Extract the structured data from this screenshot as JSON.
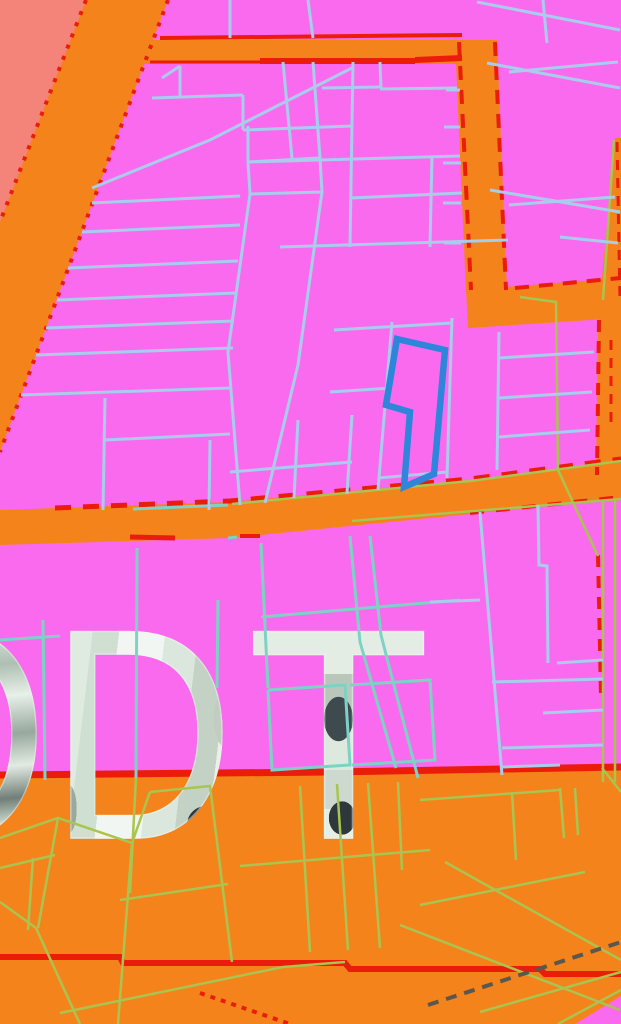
{
  "map": {
    "canvas": {
      "width": 621,
      "height": 1024
    },
    "colors": {
      "residential_zone": "#fa6aef",
      "commercial_zone": "#f5831b",
      "special_zone": "#f4837a",
      "boundary_red": "#ea1c0a",
      "parcel_blue": "#a9cbec",
      "parcel_teal": "#7dd2c5",
      "parcel_olive": "#a9c44f",
      "railway_dark": "#5a584e",
      "highlight_blue": "#2e86da"
    },
    "zones": [
      {
        "name": "zone-salmon-topleft",
        "color": "#f4837a",
        "p": "0,0 86,0 0,222"
      },
      {
        "name": "road-diagonal-band",
        "color": "#f5831b",
        "p": "86,0 168,0 0,452 0,222"
      },
      {
        "name": "road-top-horizontal",
        "color": "#f5831b",
        "p": "140,40 497,40 497,64 142,64"
      },
      {
        "name": "road-vertical-center",
        "color": "#f5831b",
        "p": "455,40 497,40 507,292 466,292"
      },
      {
        "name": "road-right-horizontal",
        "color": "#f5831b",
        "p": "466,290 621,278 621,318 468,328"
      },
      {
        "name": "road-right-sliver",
        "color": "#f5831b",
        "p": "615,138 621,138 621,300 600,300"
      },
      {
        "name": "road-right-vertical",
        "color": "#f5831b",
        "p": "598,316 621,316 621,478 596,478"
      },
      {
        "name": "road-middle-horizontal",
        "color": "#f5831b",
        "p": "0,510 230,502 470,480 621,460 621,498 470,514 230,538 0,545"
      },
      {
        "name": "zone-orange-bottom",
        "color": "#f5831b",
        "p": "0,772 330,770 621,764 621,1024 0,1024"
      },
      {
        "name": "zone-pink-corner-bottom",
        "color": "#fa6aef",
        "p": "575,1024 621,996 621,1024"
      }
    ],
    "red_solid": [
      {
        "p": "0,775 330,772 621,767",
        "w": 7
      },
      {
        "p": "0,957 120,957 123,963 345,963 350,969 540,969 545,974 621,974",
        "w": 6
      },
      {
        "p": "160,38 462,35",
        "w": 4
      },
      {
        "p": "150,62 260,62",
        "w": 3
      },
      {
        "p": "260,61 415,61",
        "w": 6
      },
      {
        "p": "415,60 462,58",
        "w": 6
      },
      {
        "p": "130,537 175,538",
        "w": 5
      },
      {
        "p": "240,536 260,536",
        "w": 4
      }
    ],
    "red_dashed": [
      {
        "p": "86,0 0,222",
        "w": 4,
        "d": "4 8"
      },
      {
        "p": "168,0 0,452",
        "w": 4,
        "d": "4 8"
      },
      {
        "p": "459,42 471,290",
        "w": 4,
        "d": "14 10"
      },
      {
        "p": "495,42 506,290",
        "w": 4,
        "d": "14 10"
      },
      {
        "p": "515,288 621,278",
        "w": 4,
        "d": "14 10"
      },
      {
        "p": "55,508 230,501 470,479 621,459",
        "w": 5,
        "d": "16 12"
      },
      {
        "p": "470,513 621,497",
        "w": 4,
        "d": "14 12"
      },
      {
        "p": "617,142 620,298",
        "w": 3,
        "d": "10 8"
      },
      {
        "p": "599,320 597,475",
        "w": 4,
        "d": "12 9"
      },
      {
        "p": "598,555 601,695",
        "w": 4,
        "d": "12 9"
      },
      {
        "p": "611,340 611,430",
        "w": 3,
        "d": "10 8"
      },
      {
        "p": "200,993 290,1024",
        "w": 4,
        "d": "5 6"
      }
    ],
    "line_groups": [
      {
        "name": "parcel-lines-olive",
        "color": "#a9c44f",
        "width": 2.5,
        "lines": [
          {
            "p": "232,504 470,481 621,461"
          },
          {
            "p": "352,521 621,499"
          },
          {
            "p": "603,500 603,782"
          },
          {
            "p": "615,500 615,782"
          },
          {
            "p": "614,140 603,300"
          },
          {
            "p": "520,297 556,302 558,470"
          },
          {
            "p": "558,470 598,556"
          },
          {
            "p": "0,838 58,818 132,843 150,792"
          },
          {
            "p": "58,818 38,928"
          },
          {
            "p": "132,843 118,1024"
          },
          {
            "p": "0,902 36,928 80,1024"
          },
          {
            "p": "150,792 210,786 232,962"
          },
          {
            "p": "120,900 228,884"
          },
          {
            "p": "60,1013 283,967 345,962"
          },
          {
            "p": "240,866 430,850"
          },
          {
            "p": "300,786 310,952"
          },
          {
            "p": "337,784 348,950"
          },
          {
            "p": "368,783 380,948"
          },
          {
            "p": "398,782 402,870"
          },
          {
            "p": "400,925 620,1010"
          },
          {
            "p": "420,800 560,790"
          },
          {
            "p": "512,792 516,860"
          },
          {
            "p": "560,788 564,838"
          },
          {
            "p": "575,788 578,835"
          },
          {
            "p": "420,905 585,872"
          },
          {
            "p": "445,862 621,960"
          },
          {
            "p": "480,1012 621,972"
          },
          {
            "p": "558,1024 621,990"
          },
          {
            "p": "602,768 621,792"
          },
          {
            "p": "136,778 130,893"
          },
          {
            "p": "0,868 55,855"
          },
          {
            "p": "33,858 28,930"
          }
        ]
      },
      {
        "name": "parcel-lines-teal",
        "color": "#7dd2c5",
        "width": 3,
        "lines": [
          {
            "p": "137,548 136,778"
          },
          {
            "p": "261,543 268,688"
          },
          {
            "p": "261,617 460,600"
          },
          {
            "p": "218,600 217,688"
          },
          {
            "p": "350,536 360,642 396,768"
          },
          {
            "p": "370,536 381,635 418,778"
          },
          {
            "p": "268,690 345,685 350,765 272,770 268,690"
          },
          {
            "p": "350,685 430,680 435,760 352,765"
          },
          {
            "p": "0,640 60,636"
          },
          {
            "p": "43,620 45,780"
          },
          {
            "p": "133,509 228,505"
          },
          {
            "p": "228,538 237,537"
          }
        ]
      },
      {
        "name": "parcel-lines-blue",
        "color": "#a9cbec",
        "width": 3,
        "lines": [
          {
            "p": "230,0 230,38"
          },
          {
            "p": "308,0 313,38"
          },
          {
            "p": "543,0 547,43"
          },
          {
            "p": "477,2 620,30"
          },
          {
            "p": "487,63 620,88"
          },
          {
            "p": "490,190 620,212"
          },
          {
            "p": "560,237 618,243"
          },
          {
            "p": "446,90 460,90"
          },
          {
            "p": "444,127 460,127"
          },
          {
            "p": "443,163 461,163"
          },
          {
            "p": "443,203 461,203"
          },
          {
            "p": "444,243 461,243"
          },
          {
            "p": "509,72 618,62"
          },
          {
            "p": "509,205 615,197"
          },
          {
            "p": "499,332 497,470"
          },
          {
            "p": "499,358 594,352"
          },
          {
            "p": "499,398 592,392"
          },
          {
            "p": "499,437 590,430"
          },
          {
            "p": "162,78 180,66"
          },
          {
            "p": "180,66 180,97"
          },
          {
            "p": "152,98 243,95"
          },
          {
            "p": "243,95 243,130"
          },
          {
            "p": "283,62 292,158"
          },
          {
            "p": "313,62 320,158"
          },
          {
            "p": "322,88 380,87"
          },
          {
            "p": "380,89 457,88"
          },
          {
            "p": "380,62 381,88"
          },
          {
            "p": "243,130 353,126"
          },
          {
            "p": "353,62 350,247"
          },
          {
            "p": "248,162 460,156"
          },
          {
            "p": "432,156 430,247"
          },
          {
            "p": "350,198 462,193"
          },
          {
            "p": "280,247 508,240"
          },
          {
            "p": "248,126 248,162"
          },
          {
            "p": "248,162 320,158 322,192 250,194 248,162"
          },
          {
            "p": "250,194 228,352 240,505"
          },
          {
            "p": "322,192 298,365 265,503"
          },
          {
            "p": "334,330 452,323"
          },
          {
            "p": "330,392 392,388"
          },
          {
            "p": "392,322 378,490"
          },
          {
            "p": "452,318 447,478"
          },
          {
            "p": "230,472 352,462"
          },
          {
            "p": "298,420 294,498"
          },
          {
            "p": "352,415 347,494"
          },
          {
            "p": "378,478 447,472"
          },
          {
            "p": "352,68 210,140 92,188"
          },
          {
            "p": "92,203 240,196"
          },
          {
            "p": "82,232 240,225"
          },
          {
            "p": "68,268 238,261"
          },
          {
            "p": "57,300 236,293"
          },
          {
            "p": "46,328 234,321"
          },
          {
            "p": "36,355 233,348"
          },
          {
            "p": "21,395 231,388"
          },
          {
            "p": "105,440 230,434"
          },
          {
            "p": "105,398 103,510"
          },
          {
            "p": "210,440 209,510"
          },
          {
            "p": "480,512 502,775"
          },
          {
            "p": "538,505 539,565 547,566 548,663"
          },
          {
            "p": "430,602 480,600"
          },
          {
            "p": "557,663 603,660"
          },
          {
            "p": "492,682 603,679"
          },
          {
            "p": "543,713 603,710"
          },
          {
            "p": "502,748 603,745"
          },
          {
            "p": "502,767 560,765"
          }
        ]
      },
      {
        "name": "railway-dashed",
        "color": "#5a584e",
        "width": 4,
        "dash": "11 8",
        "lines": [
          {
            "p": "428,1005 621,942"
          }
        ]
      }
    ],
    "highlight_parcel": {
      "p": "397,339 445,350 434,474 404,487 410,412 386,405",
      "color": "#2e86da",
      "w": 6.5
    },
    "label": {
      "text": "ODT",
      "font_px": 300,
      "items": [
        {
          "char": "O",
          "x": -150,
          "y": 584,
          "sx": 0.85,
          "style": "glyph-o"
        },
        {
          "char": "D",
          "x": 50,
          "y": 584,
          "sx": 0.85,
          "style": "glyph-d"
        },
        {
          "char": "T",
          "x": 247,
          "y": 584,
          "sx": 1.0,
          "style": "glyph-t"
        }
      ]
    }
  }
}
